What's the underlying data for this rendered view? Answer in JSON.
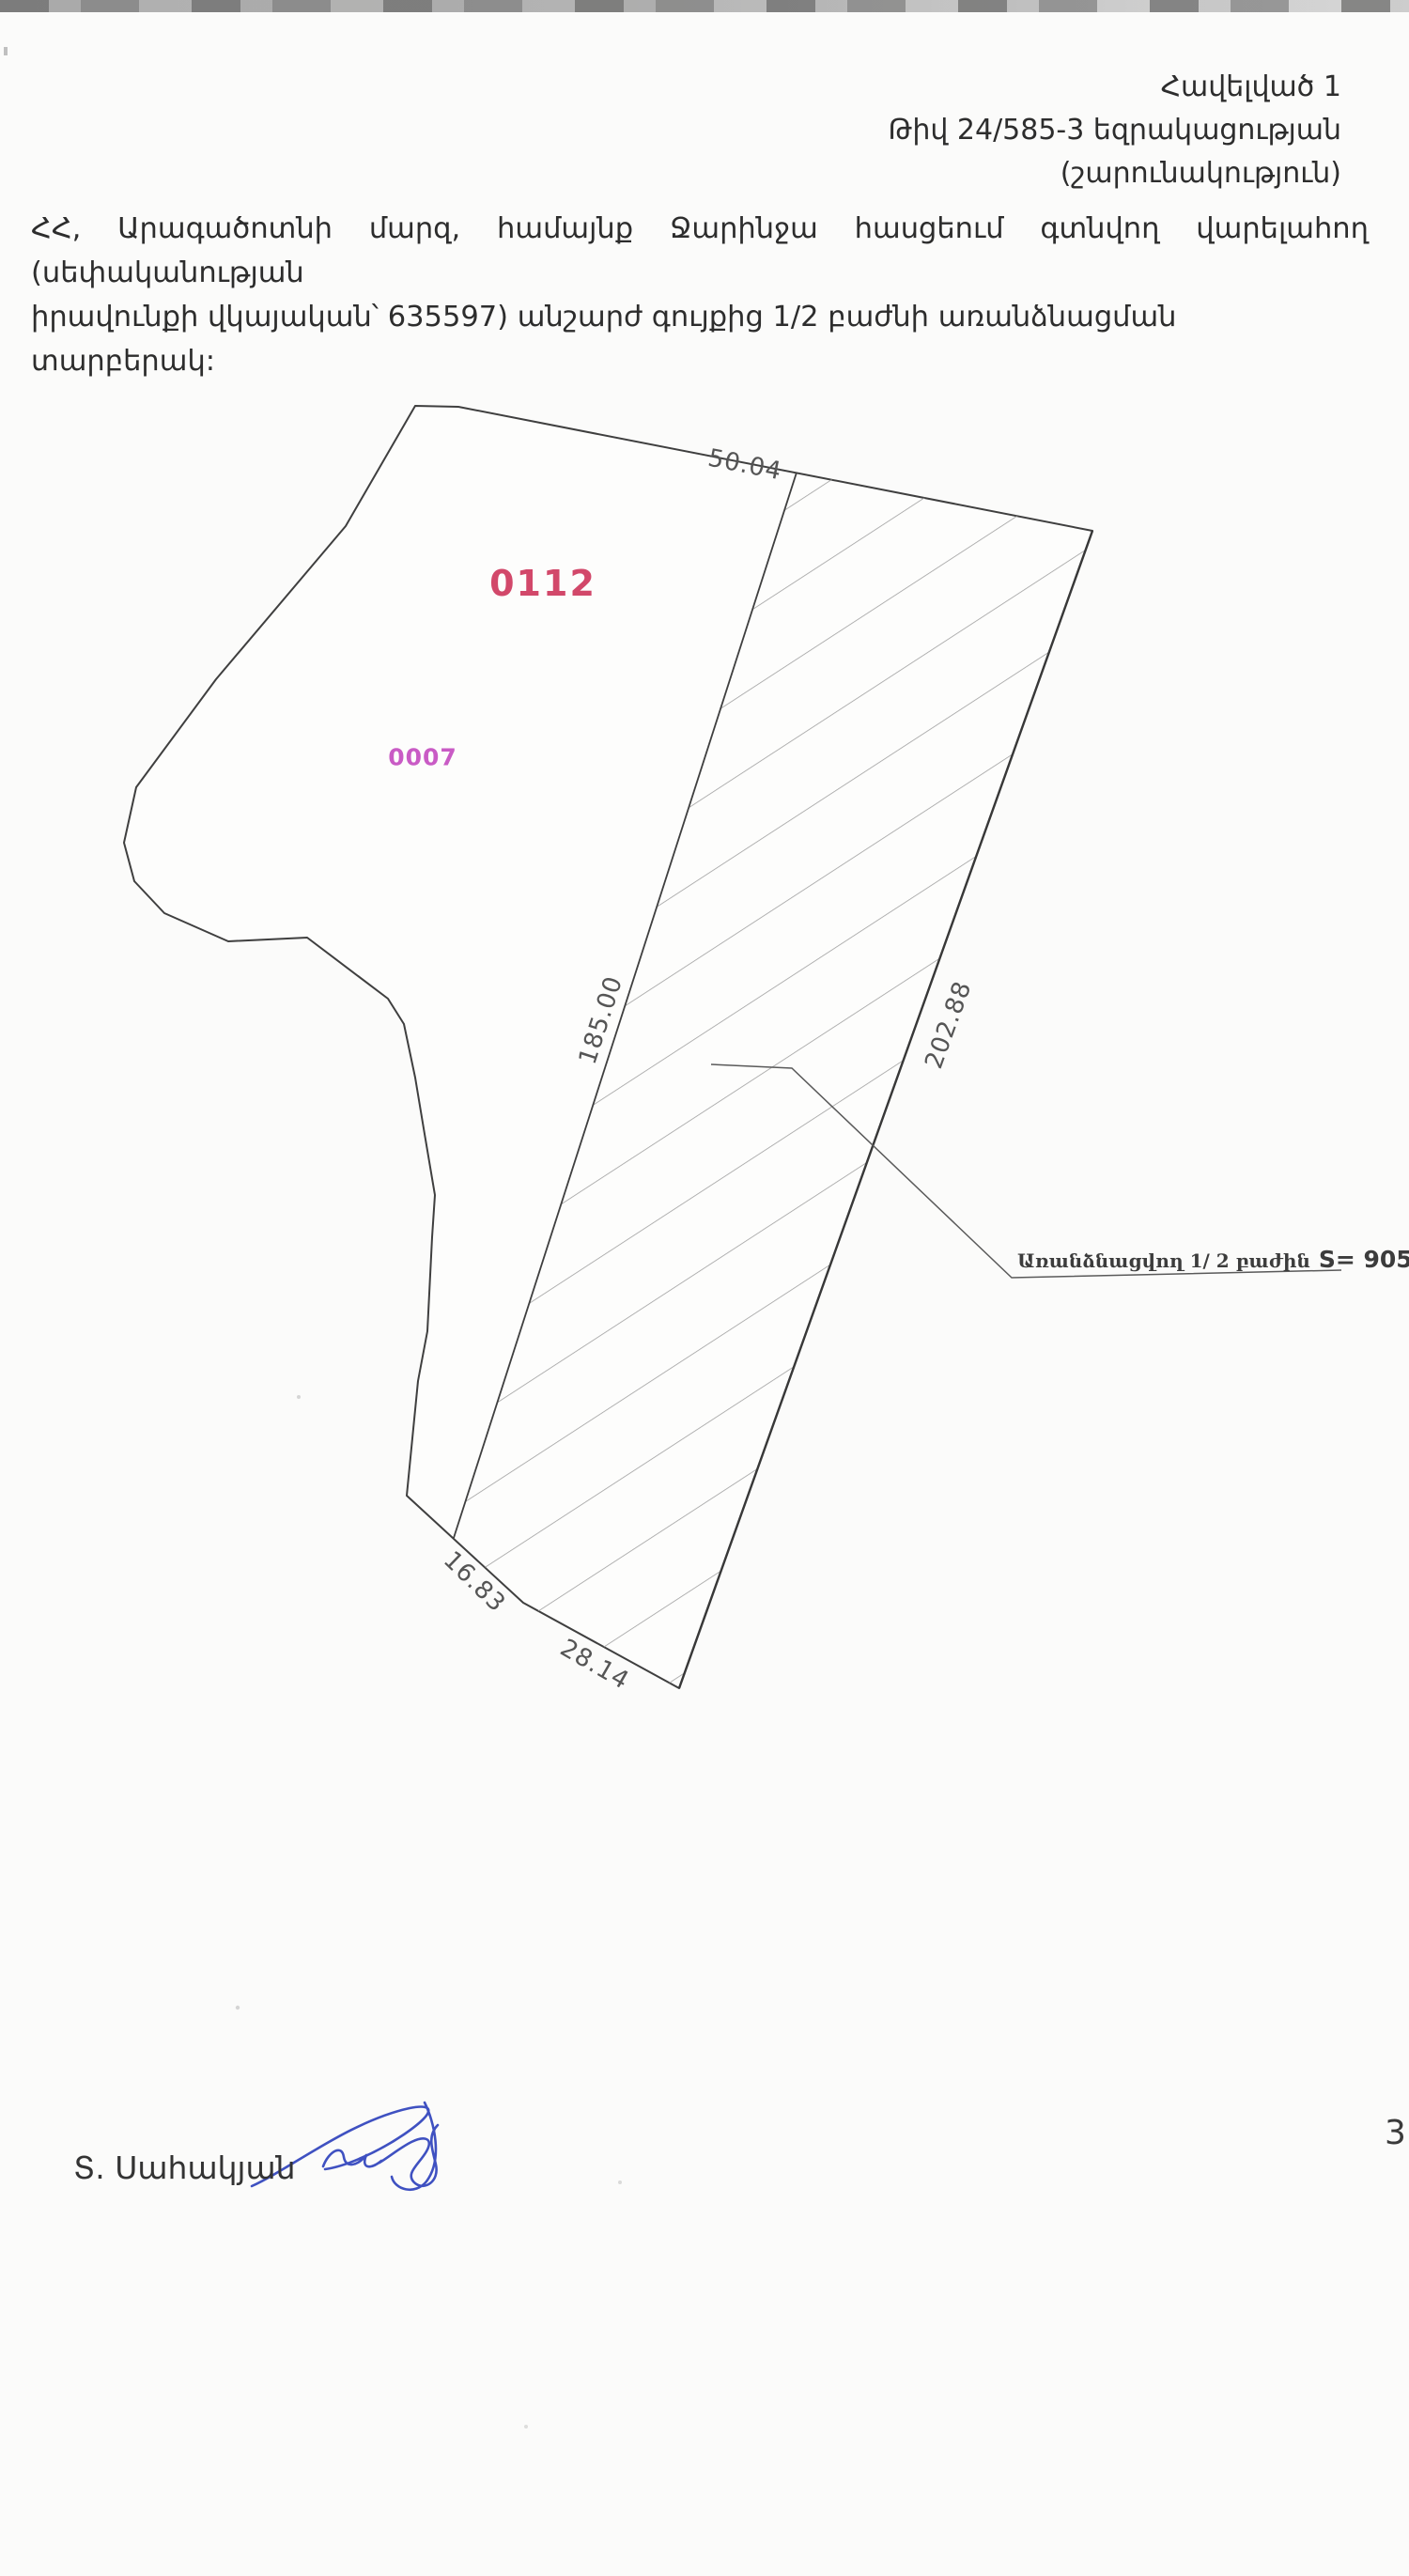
{
  "header": {
    "appendix": "Հավելված 1",
    "conclusion": "Թիվ 24/585-3 եզրակացության",
    "continuation": "(շարունակություն)"
  },
  "paragraph": {
    "line1": "ՀՀ, Արագածոտնի մարզ, համայնք Ջարինջա հասցեում գտնվող վարելահող (սեփականության",
    "line2": "իրավունքի վկայական՝ 635597) անշարժ գույքից 1/2 բաժնի առանձնացման տարբերակ:"
  },
  "plan": {
    "parcel_code": "0112",
    "neighbor_code": "0007",
    "dimensions": {
      "top": "50.04",
      "left_side": "185.00",
      "right_side": "202.88",
      "bottom_left": "16.83",
      "bottom_right": "28.14"
    },
    "callout": {
      "text": "Առանձնացվող 1/ 2 բաժին",
      "area": "S= 9050քմ"
    }
  },
  "signature": {
    "name": "Տ. Սահակյան"
  },
  "page_number": "3",
  "colors": {
    "parcel_code": "#d2486a",
    "neighbor_code": "#c95bc5",
    "drawing_line": "#3f3f3f",
    "hatch_line": "#9a9a9a",
    "dimension_text": "#555555",
    "body_text": "#2d2d2d",
    "signature_ink": "#3f51c1"
  }
}
